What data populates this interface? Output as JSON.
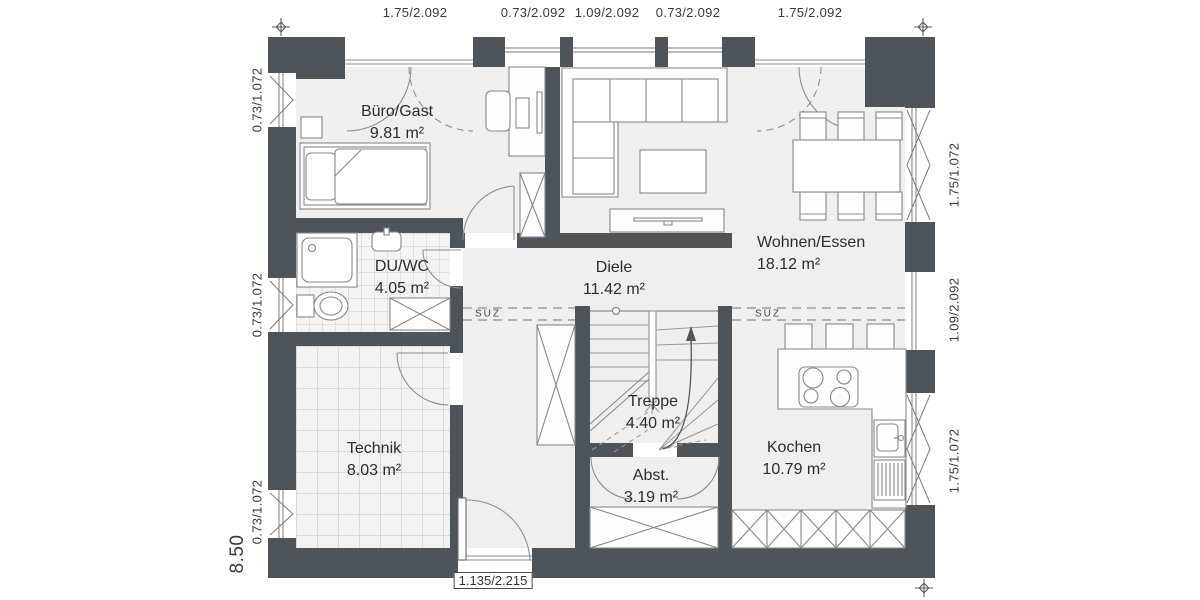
{
  "rooms": {
    "buero": {
      "name": "Büro/Gast",
      "area": "9.81 m²"
    },
    "duwc": {
      "name": "DU/WC",
      "area": "4.05 m²"
    },
    "diele": {
      "name": "Diele",
      "area": "11.42 m²"
    },
    "wohnen": {
      "name": "Wohnen/Essen",
      "area": "18.12 m²"
    },
    "treppe": {
      "name": "Treppe",
      "area": "4.40 m²"
    },
    "technik": {
      "name": "Technik",
      "area": "8.03 m²"
    },
    "abst": {
      "name": "Abst.",
      "area": "3.19 m²"
    },
    "kochen": {
      "name": "Kochen",
      "area": "10.79 m²"
    }
  },
  "dimensions": {
    "top": [
      "1.75/2.092",
      "0.73/2.092",
      "1.09/2.092",
      "0.73/2.092",
      "1.75/2.092"
    ],
    "left": [
      "0.73/1.072",
      "0.73/1.072",
      "0.73/1.072"
    ],
    "right": [
      "1.75/1.072",
      "1.09/2.092",
      "1.75/1.072"
    ],
    "building_width": "8.50",
    "entrance_door": "1.135/2.215"
  },
  "annotations": {
    "suz": "SUZ"
  },
  "colors": {
    "wall": "#4d545a",
    "floor": "#efefef",
    "line": "#8a8a8a",
    "text": "#2d2d2d"
  }
}
